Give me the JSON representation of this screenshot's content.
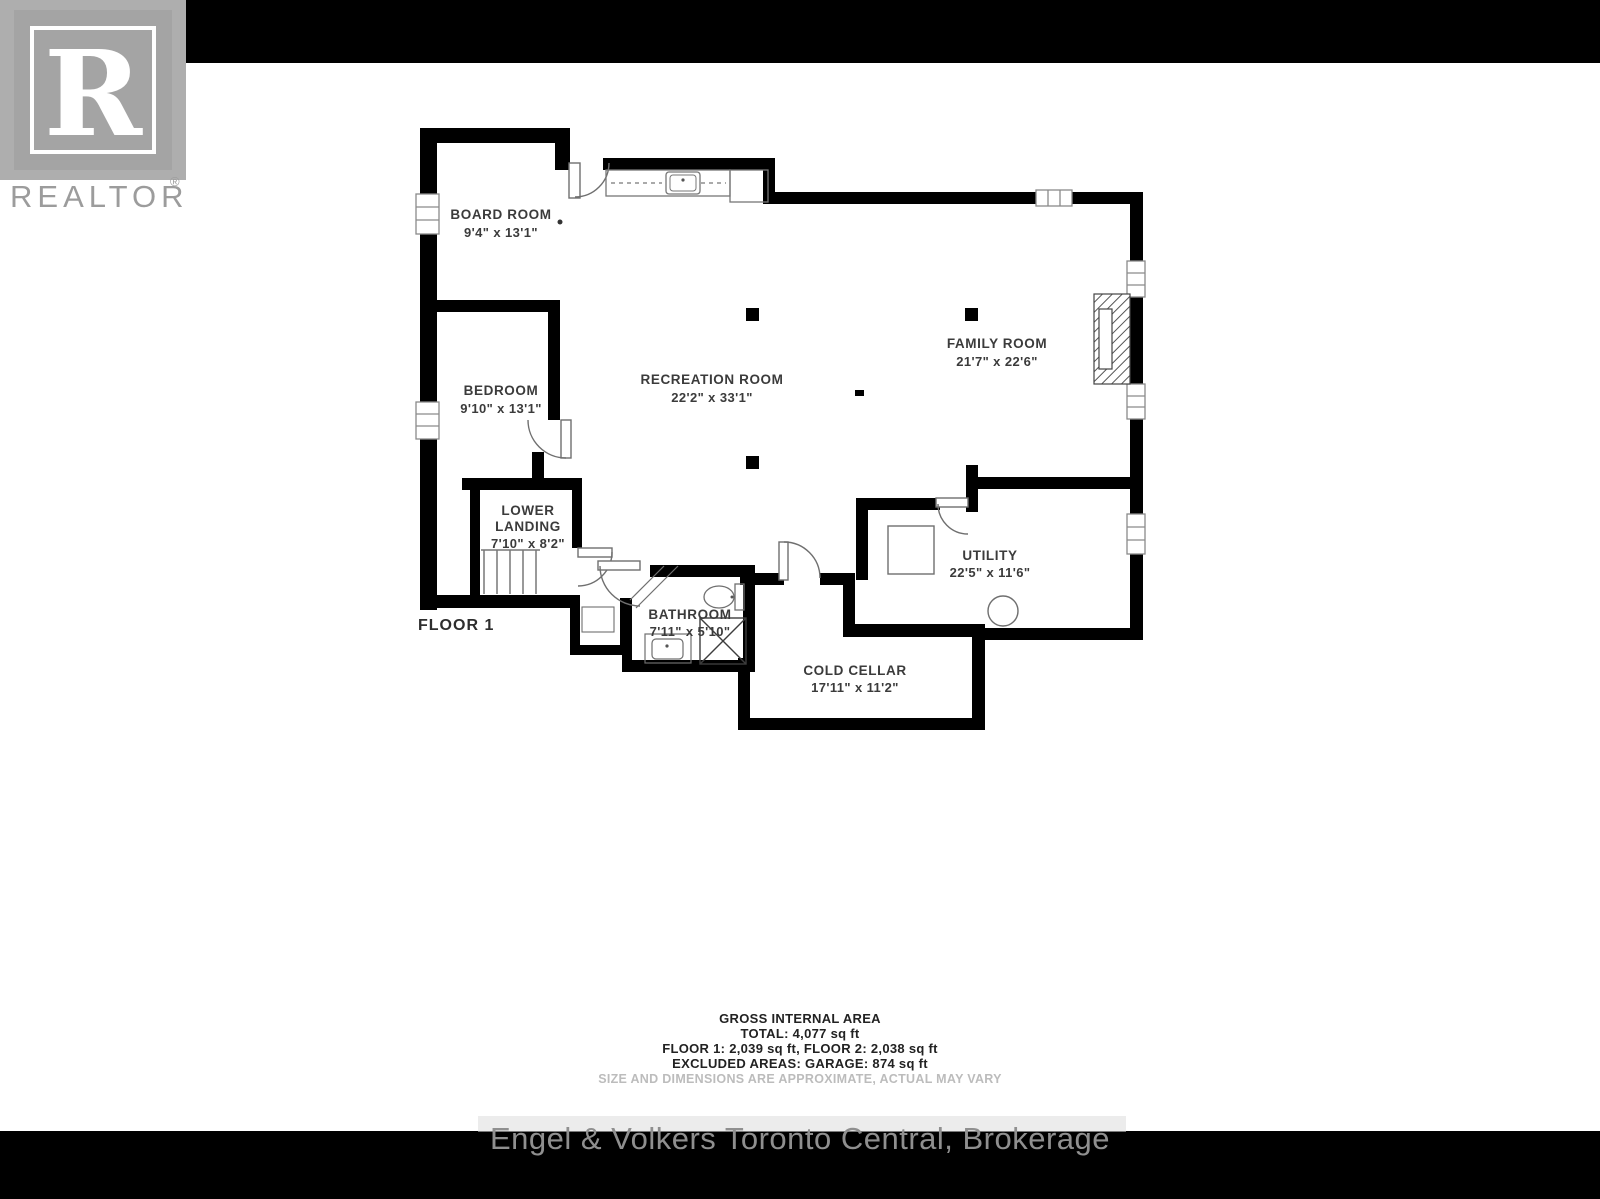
{
  "branding": {
    "logo_letter": "R",
    "logo_text": "REALTOR",
    "registered_mark": "®"
  },
  "floor_label": "FLOOR 1",
  "rooms": [
    {
      "name": "BOARD ROOM",
      "dims": "9'4\" x 13'1\""
    },
    {
      "name": "BEDROOM",
      "dims": "9'10\" x 13'1\""
    },
    {
      "name_line1": "LOWER",
      "name_line2": "LANDING",
      "dims": "7'10\" x 8'2\""
    },
    {
      "name": "RECREATION ROOM",
      "dims": "22'2\" x 33'1\""
    },
    {
      "name": "FAMILY ROOM",
      "dims": "21'7\" x 22'6\""
    },
    {
      "name": "UTILITY",
      "dims": "22'5\" x 11'6\""
    },
    {
      "name": "BATHROOM",
      "dims": "7'11\" x 5'10\""
    },
    {
      "name": "COLD CELLAR",
      "dims": "17'11\" x 11'2\""
    }
  ],
  "area_summary": {
    "line1": "GROSS INTERNAL AREA",
    "line2": "TOTAL: 4,077 sq ft",
    "line3": "FLOOR 1: 2,039 sq ft, FLOOR 2: 2,038 sq ft",
    "line4": "EXCLUDED AREAS: GARAGE: 874 sq ft",
    "disclaimer": "SIZE AND DIMENSIONS ARE APPROXIMATE, ACTUAL MAY VARY"
  },
  "footer": {
    "brokerage": "Engel & Volkers Toronto Central, Brokerage"
  },
  "colors": {
    "wall": "#000000",
    "label_text": "#3b3b3b",
    "fixture_line": "#777777",
    "logo_gray": "#a4a4a4",
    "top_bar": "#000000",
    "bottom_bar": "#000000",
    "footer_text": "#8f8f8f",
    "disclaimer_text": "#bcbcbc"
  }
}
